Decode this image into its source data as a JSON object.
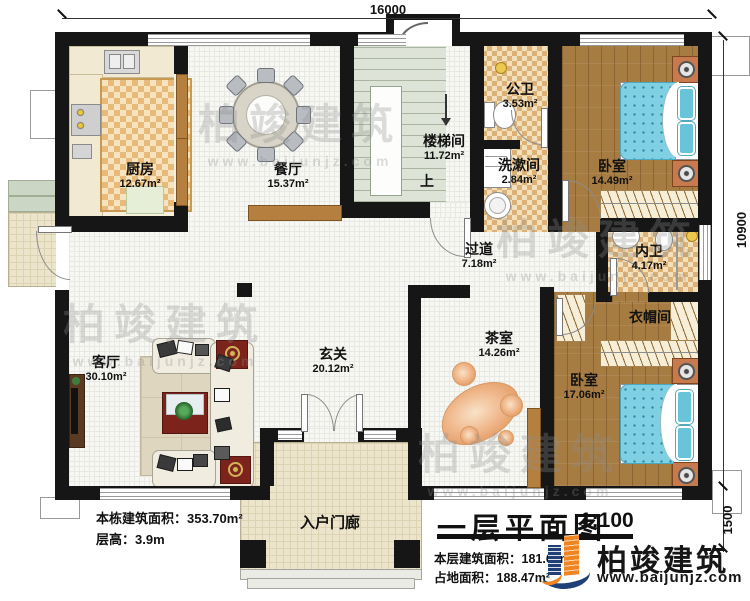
{
  "dimensions": {
    "top": "16000",
    "right_main": "10900",
    "right_lower": "1500"
  },
  "rooms": [
    {
      "name": "厨房",
      "area": "12.67m²"
    },
    {
      "name": "餐厅",
      "area": "15.37m²"
    },
    {
      "name": "楼梯间",
      "area": "11.72m²"
    },
    {
      "name": "公卫",
      "area": "3.53m²"
    },
    {
      "name": "洗漱间",
      "area": "2.84m²"
    },
    {
      "name": "卧室",
      "area": "14.49m²"
    },
    {
      "name": "内卫",
      "area": "4.17m²"
    },
    {
      "name": "过道",
      "area": "7.18m²"
    },
    {
      "name": "衣帽间",
      "area": ""
    },
    {
      "name": "卧室",
      "area": "17.06m²"
    },
    {
      "name": "茶室",
      "area": "14.26m²"
    },
    {
      "name": "玄关",
      "area": "20.12m²"
    },
    {
      "name": "客厅",
      "area": "30.10m²"
    },
    {
      "name": "入户门廊",
      "area": ""
    }
  ],
  "stair": {
    "up_label": "上"
  },
  "stats": {
    "building_area": "本栋建筑面积：353.70m²",
    "floor_height": "层高：3.9m"
  },
  "titleblock": {
    "title": "一层平面图",
    "scale": "1:100",
    "floor_area": "本层建筑面积：181.69m²",
    "land_area": "占地面积：188.47m²"
  },
  "brand": {
    "name": "柏竣建筑",
    "url": "www.baijunjz.com"
  },
  "watermark": {
    "name": "柏竣建筑",
    "url": "www.baijunjz.com"
  },
  "colors": {
    "wall": "#161616",
    "wood_floor": "#a67c42",
    "tile_checker": "#dcb177",
    "bed_blue": "#7fd0e2",
    "brand_blue": "#1e4077",
    "brand_orange": "#f08421"
  }
}
